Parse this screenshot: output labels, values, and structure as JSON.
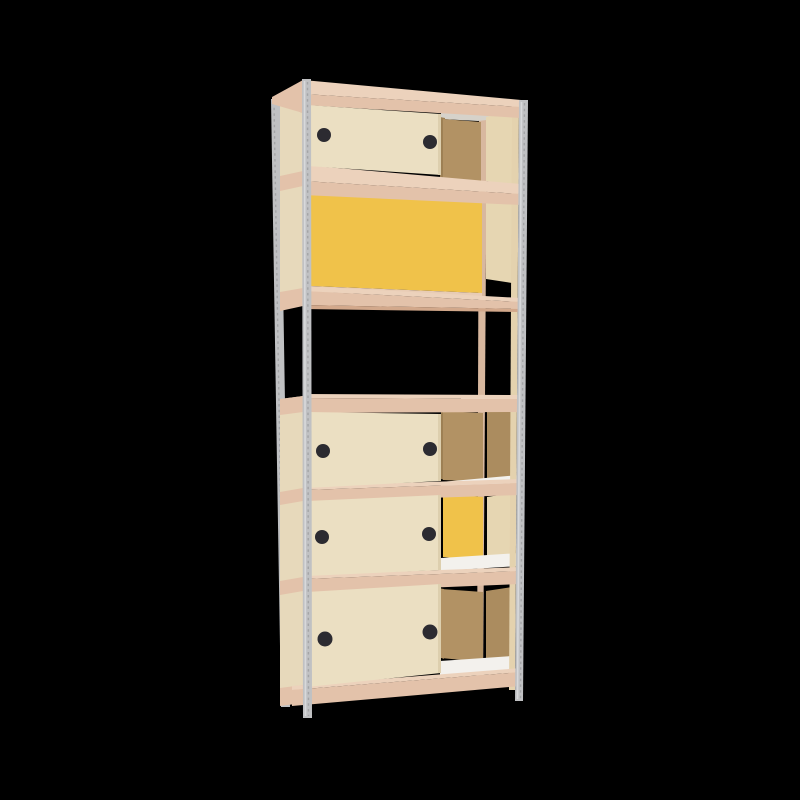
{
  "scene": {
    "title": "tall-shelving-unit-with-sliding-door-cabinets",
    "background": "black",
    "frame": {
      "posts": "perforated light-grey metal angle posts, 4 legs",
      "slabs": 7,
      "slab_material": "pale pink-tan wood",
      "bays": "wide left bay with cabinet boxes, narrow right bay, wooden center divider"
    },
    "sections": [
      {
        "name": "top-cabinet",
        "front_door": "cream sliding door, 2 black finger holes",
        "rear_panel": "plywood brown",
        "right_bay": "cream panel",
        "ceiling_sliver": "grey"
      },
      {
        "name": "yellow-cabinet",
        "front_door": "none (open track)",
        "rear_panel": "yellow sliding door fully visible",
        "right_bay": "cream panel"
      },
      {
        "name": "open-shelf",
        "front_door": "none",
        "contents": "empty, see-through to black background"
      },
      {
        "name": "mid-cabinet",
        "front_door": "cream sliding door, 2 black finger holes",
        "rear_panel": "plywood brown",
        "right_bay": "plywood brown panel",
        "floor": "white"
      },
      {
        "name": "yellow-mid-cabinet",
        "front_door": "cream sliding door, 2 black finger holes",
        "rear_panel": "yellow sliding door",
        "right_bay": "cream panel",
        "floor": "white"
      },
      {
        "name": "bottom-cabinet",
        "front_door": "cream sliding door, 2 black finger holes",
        "rear_panel": "plywood brown",
        "right_bay": "plywood brown panel",
        "floor": "white"
      }
    ],
    "handle_count_total": 8
  },
  "colors": {
    "bg": "#000000",
    "metal": "#c0c1c3",
    "metalLight": "#d8d9db",
    "metalDark": "#a3a4a6",
    "slabTop": "#ecd2bc",
    "slabFront": "#e3c2aa",
    "slabShade": "#d2a88b",
    "slabRail": "#e8ccb5",
    "doorCream": "#ebdfc2",
    "doorCreamShade": "#ddcfae",
    "sideCream": "#e7d9bb",
    "wallCream": "#e6d6b2",
    "ceiling": "#d6d2ca",
    "yellow": "#f0c24a",
    "brown": "#b29264",
    "brownWall": "#ab8c5f",
    "brownDark": "#9d8054",
    "white": "#f3f1ed",
    "handle": "#2c2b31",
    "dividerTan": "#d8b89f",
    "innerStrip": "#e4d2ae"
  }
}
